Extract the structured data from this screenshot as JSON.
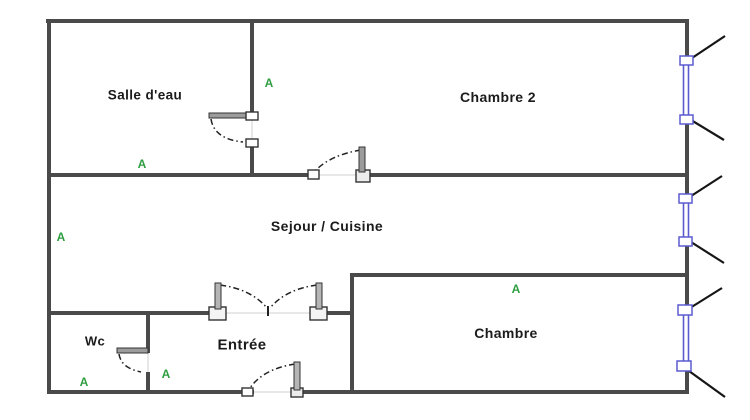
{
  "diagram": {
    "type": "floor-plan",
    "background_color": "#ffffff",
    "wall_color": "#4a4a4a",
    "window_color": "#5b5bd0",
    "marker_color": "#2f9e41",
    "label_color": "#1b1b1b"
  },
  "rooms": [
    {
      "id": "salle-deau",
      "label": "Salle d'eau"
    },
    {
      "id": "chambre-2",
      "label": "Chambre 2"
    },
    {
      "id": "sejour-cuisine",
      "label": "Sejour / Cuisine"
    },
    {
      "id": "wc",
      "label": "Wc"
    },
    {
      "id": "entree",
      "label": "Entrée"
    },
    {
      "id": "chambre",
      "label": "Chambre"
    }
  ],
  "markers": [
    {
      "label": "A",
      "location": "chambre-2-left"
    },
    {
      "label": "A",
      "location": "salle-deau-bottom"
    },
    {
      "label": "A",
      "location": "sejour-left"
    },
    {
      "label": "A",
      "location": "chambre-top"
    },
    {
      "label": "A",
      "location": "wc-bottom"
    },
    {
      "label": "A",
      "location": "entree-left"
    },
    {
      "label": "A",
      "location": "sejour-bottom-left"
    }
  ],
  "doors": [
    {
      "name": "salle-deau-door",
      "wall": "between Salle d'eau and Chambre 2"
    },
    {
      "name": "chambre-2-door",
      "wall": "between Sejour/Cuisine and Chambre 2"
    },
    {
      "name": "double-door-sejour",
      "wall": "between Entrée and Sejour/Cuisine"
    },
    {
      "name": "wc-door",
      "wall": "between Wc and Entrée"
    },
    {
      "name": "entry-door",
      "wall": "bottom exterior wall of Entrée"
    }
  ],
  "windows": [
    {
      "name": "window-chambre-2",
      "wall": "right exterior"
    },
    {
      "name": "window-sejour",
      "wall": "right exterior"
    },
    {
      "name": "window-chambre",
      "wall": "right exterior"
    }
  ]
}
